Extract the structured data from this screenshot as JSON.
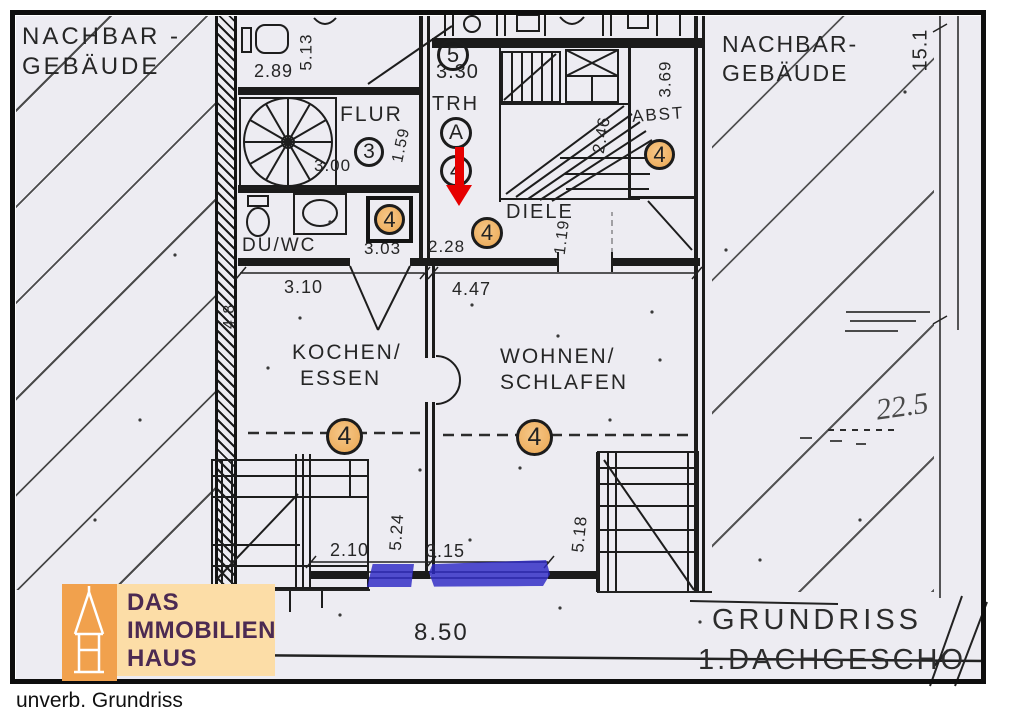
{
  "plan_title": {
    "line1": "GRUNDRISS",
    "line2": "1.DACHGESCHO"
  },
  "caption": "unverb. Grundriss",
  "logo": {
    "line1": "DAS",
    "line2": "IMMOBILIEN",
    "line3": "HAUS"
  },
  "neighbor_left": {
    "line1": "NACHBAR -",
    "line2": "GEBÄUDE"
  },
  "neighbor_right": {
    "line1": "NACHBAR-",
    "line2": "GEBÄUDE"
  },
  "rooms": {
    "flur": "FLUR",
    "trh": "TRH",
    "diele": "DIELE",
    "duwc": "DU/WC",
    "abst": "ABST",
    "kochen_line1": "KOCHEN/",
    "kochen_line2": "ESSEN",
    "wohnen_line1": "WOHNEN/",
    "wohnen_line2": "SCHLAFEN"
  },
  "markers": {
    "top_count": "5",
    "flur_count": "3",
    "staircase": "A",
    "unit_count": "4"
  },
  "dims": {
    "bath_width": "2.89",
    "bath_depth": "5.13",
    "flur_width": "3.00",
    "flur_depth": "1.59",
    "trh_width": "3.30",
    "stair_depth": "2.46",
    "abst_depth": "3.69",
    "duwc_width": "3.03",
    "trh_lower_width": "2.28",
    "diele_depth": "1.19",
    "kochen_width": "3.10",
    "wohnen_width": "4.47",
    "side_height": "4.8",
    "terrace_width": "2.10",
    "kochen_depth": "5.24",
    "window_width": "3.15",
    "wohnen_depth": "5.18",
    "house_width": "8.50",
    "house_depth": "15.1",
    "handwritten_area": "22.5"
  },
  "colors": {
    "marker_highlight": "#f0b469",
    "window_highlight": "#2d28c5",
    "arrow": "#e60000",
    "logo_square": "#f1a14d",
    "logo_plate": "#fcdda7",
    "logo_text": "#4c2a52"
  }
}
